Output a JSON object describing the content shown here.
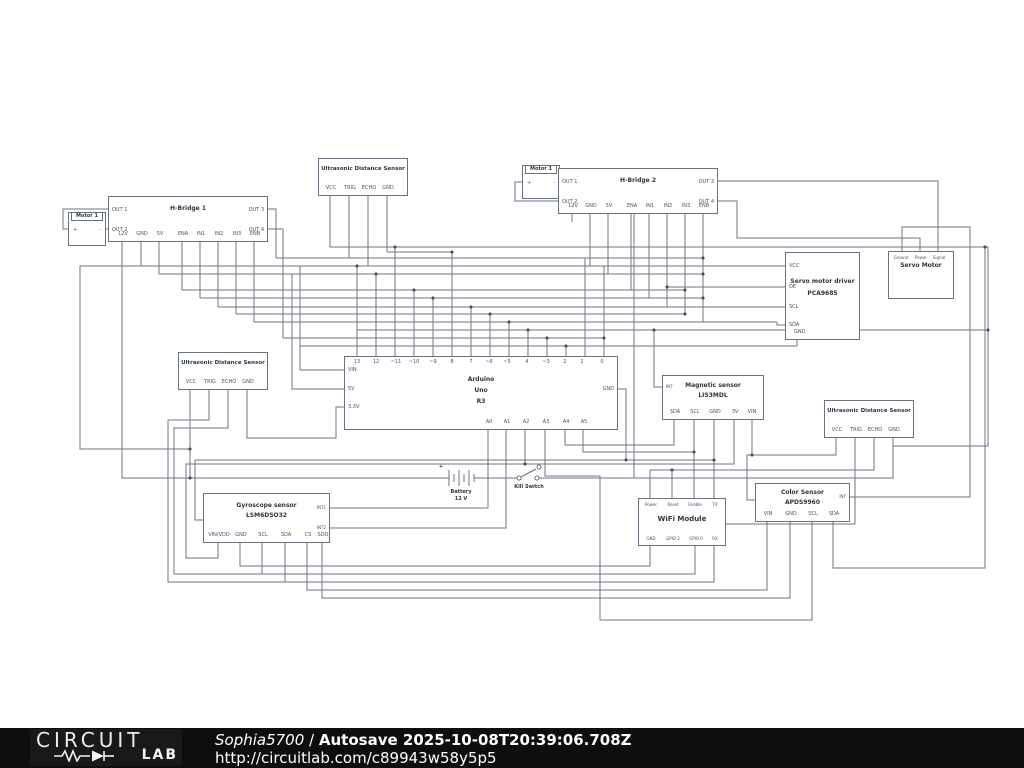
{
  "footer": {
    "brand_top": "CIRCUIT",
    "brand_bottom": "LAB",
    "author": "Sophia5700",
    "sep": "/",
    "autosave": "Autosave 2025-10-08T20:39:06.708Z",
    "url": "http://circuitlab.com/c89943w58y5p5"
  },
  "colors": {
    "wire": "#6d7580",
    "text": "#383e44",
    "footer_bg": "#0e0e0e"
  },
  "components": {
    "motor_left": {
      "title": "Motor 1",
      "plus": "+",
      "minus": "-"
    },
    "motor_right": {
      "title": "Motor 1",
      "plus": "+",
      "minus": "-"
    },
    "hbridge1": {
      "title": "H-Bridge 1",
      "left": [
        "OUT 1",
        "OUT 2"
      ],
      "right": [
        "OUT 3",
        "OUT 4"
      ],
      "bottom": [
        "12V",
        "GND",
        "5V",
        "ENA",
        "IN1",
        "IN2",
        "IN3",
        "ENB"
      ]
    },
    "hbridge2": {
      "title": "H-Bridge 2",
      "left": [
        "OUT 1",
        "OUT 2"
      ],
      "right": [
        "OUT 3",
        "OUT 4"
      ],
      "bottom": [
        "12V",
        "GND",
        "5V",
        "ENA",
        "IN1",
        "IN2",
        "IN3",
        "ENB"
      ]
    },
    "ultrasonic_top": {
      "title": "Ultrasonic Distance Sensor",
      "bottom": [
        "VCC",
        "TRIG",
        "ECHO",
        "GND"
      ]
    },
    "ultrasonic_left": {
      "title": "Ultrasonic Distance Sensor",
      "bottom": [
        "VCC",
        "TRIG",
        "ECHO",
        "GND"
      ]
    },
    "ultrasonic_right": {
      "title": "Ultrasonic Distance Sensor",
      "bottom": [
        "VCC",
        "TRIG",
        "ECHO",
        "GND"
      ]
    },
    "arduino": {
      "title1": "Arduino",
      "title2": "Uno",
      "title3": "R3",
      "top": [
        "13",
        "12",
        "~11",
        "~10",
        "~9",
        "8",
        "7",
        "~6",
        "~5",
        "4",
        "~3",
        "2",
        "1",
        "0"
      ],
      "left": [
        "VIN",
        "5V",
        "3.3V"
      ],
      "right": [
        "GND"
      ],
      "bottom": [
        "A0",
        "A1",
        "A2",
        "A3",
        "A4",
        "A5"
      ]
    },
    "servo_driver": {
      "title1": "Servo motor driver",
      "title2": "PCA9685",
      "left": [
        "VCC",
        "OE",
        "SCL",
        "SDA"
      ],
      "bottom": [
        "GND"
      ]
    },
    "servo_motor": {
      "title": "Servo Motor",
      "top": [
        "Ground",
        "Power",
        "Signal"
      ]
    },
    "magnetic": {
      "title1": "Magnetic sensor",
      "title2": "LIS3MDL",
      "left": [
        "INT"
      ],
      "bottom": [
        "SDA",
        "SCL",
        "GND",
        "3V",
        "VIN"
      ]
    },
    "gyroscope": {
      "title1": "Gyroscope sensor",
      "title2": "LSM6DSO32",
      "right": [
        "INT1",
        "INT2"
      ],
      "bottom": [
        "VIN/VDD",
        "GND",
        "SCL",
        "SDA",
        "CS",
        "SDO"
      ]
    },
    "wifi": {
      "title": "WiFi Module",
      "top": [
        "Power",
        "Reset",
        "Enable",
        "TX"
      ],
      "bottom": [
        "GND",
        "GPIO 2",
        "GPIO 0",
        "RX"
      ]
    },
    "color": {
      "title1": "Color Sensor",
      "title2": "APDS9960",
      "right": [
        "INT"
      ],
      "bottom": [
        "VIN",
        "GND",
        "SCL",
        "SDA"
      ]
    },
    "battery": {
      "label1": "Battery",
      "label2": "12 V",
      "plus": "+"
    },
    "kill_switch": {
      "label": "Kill Switch"
    }
  }
}
